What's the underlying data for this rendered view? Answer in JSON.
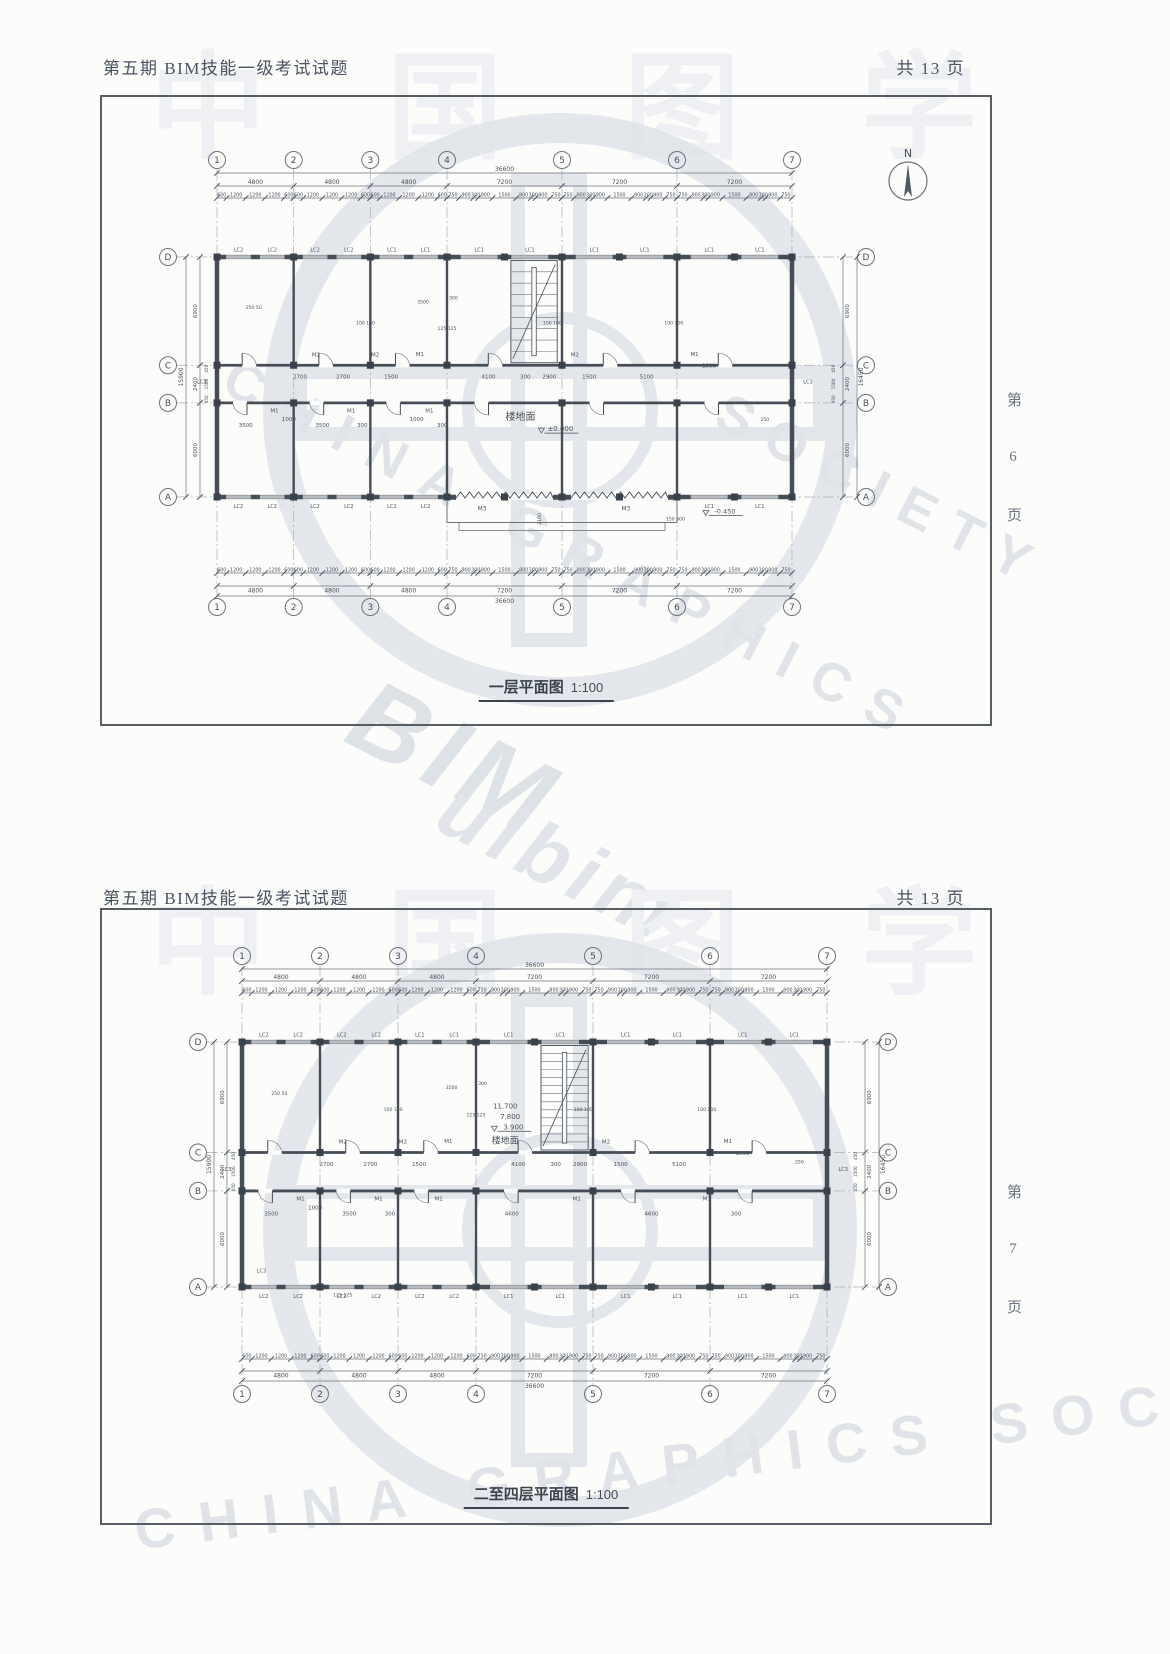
{
  "doc": {
    "header_title": "第五期 BIM技能一级考试试题",
    "pages_label": "共  13  页",
    "watermark": {
      "top_chars": "中 国 图 学",
      "diag_en1": "CHINA GRAPHICS",
      "diag_en2": "SOCIETY",
      "diag_en3": "CHINA GRAPHICS SOCIETY",
      "big1": "BIM",
      "big2": "uibim"
    }
  },
  "sections": [
    {
      "title": "一层平面图",
      "scale": "1:100",
      "side_page": "第 6 页",
      "north": "N",
      "axes_cols": [
        "1",
        "2",
        "3",
        "4",
        "5",
        "6",
        "7"
      ],
      "axes_rows": [
        "D",
        "C",
        "B",
        "A"
      ],
      "bays_mm": [
        4800,
        4800,
        4800,
        7200,
        7200,
        7200
      ],
      "rows_mm": [
        6900,
        2400,
        6000
      ],
      "dim_total_top": "36600",
      "dim_total_bottom": "36600",
      "detail_4800": [
        600,
        1200,
        1200,
        1200,
        600
      ],
      "detail_7200": [
        750,
        900,
        300,
        900,
        1500,
        900,
        300,
        900,
        750
      ],
      "side_left_total": "15900",
      "side_right_total": "16450",
      "side_sub": [
        450,
        1500,
        450
      ],
      "windows_top_bays": [
        [
          "LC2",
          "LC2"
        ],
        [
          "LC2",
          "LC2"
        ],
        [
          "LC1",
          "LC1"
        ],
        [
          "LC1",
          "LC1"
        ],
        [
          "LC1",
          "LC1"
        ],
        [
          "LC1",
          "LC1"
        ]
      ],
      "windows_bottom_bays": [
        [
          "LC2",
          "LC2"
        ],
        [
          "LC2",
          "LC2"
        ],
        [
          "LC2",
          "LC2"
        ],
        [],
        [],
        [
          "LC1",
          "LC1"
        ]
      ],
      "porch": true,
      "stair_treads": 8,
      "interior_labels": [
        {
          "t": "M2",
          "x": 6200,
          "y": 6350
        },
        {
          "t": "2700",
          "x": 5200,
          "y": 7750
        },
        {
          "t": "2700",
          "x": 7900,
          "y": 7750
        },
        {
          "t": "M2",
          "x": 9900,
          "y": 6350
        },
        {
          "t": "1500",
          "x": 10900,
          "y": 7750
        },
        {
          "t": "M1",
          "x": 12700,
          "y": 6300
        },
        {
          "t": "4100",
          "x": 17000,
          "y": 7750
        },
        {
          "t": "300",
          "x": 19300,
          "y": 7750
        },
        {
          "t": "2900",
          "x": 20800,
          "y": 7750
        },
        {
          "t": "M2",
          "x": 22400,
          "y": 6350
        },
        {
          "t": "1500",
          "x": 23300,
          "y": 7750
        },
        {
          "t": "5100",
          "x": 26900,
          "y": 7750
        },
        {
          "t": "M1",
          "x": 29900,
          "y": 6300
        },
        {
          "t": "1000",
          "x": 30800,
          "y": 7050
        },
        {
          "t": "M1",
          "x": 3600,
          "y": 9900
        },
        {
          "t": "1000",
          "x": 4500,
          "y": 10450
        },
        {
          "t": "3500",
          "x": 1800,
          "y": 10850
        },
        {
          "t": "M1",
          "x": 8400,
          "y": 9900
        },
        {
          "t": "3500",
          "x": 6600,
          "y": 10850
        },
        {
          "t": "300",
          "x": 9100,
          "y": 10850
        },
        {
          "t": "M1",
          "x": 13300,
          "y": 9900
        },
        {
          "t": "1000",
          "x": 12500,
          "y": 10450
        },
        {
          "t": "300",
          "x": 14100,
          "y": 10850
        },
        {
          "t": "楼地面",
          "x": 19000,
          "y": 10400,
          "s": 10
        },
        {
          "t": "±0.000",
          "x": 21500,
          "y": 11100,
          "s": 7,
          "lvl": true
        },
        {
          "t": "100 100",
          "x": 9300,
          "y": 4300,
          "s": 4.6
        },
        {
          "t": "125 125",
          "x": 14400,
          "y": 4650,
          "s": 4.6
        },
        {
          "t": "100 100",
          "x": 21000,
          "y": 4300,
          "s": 4.6
        },
        {
          "t": "100 100",
          "x": 28600,
          "y": 4300,
          "s": 4.6
        },
        {
          "t": "250 50",
          "x": 2300,
          "y": 3300,
          "s": 4.6
        },
        {
          "t": "3500",
          "x": 12900,
          "y": 2950,
          "s": 4.6
        },
        {
          "t": "300",
          "x": 14800,
          "y": 2700,
          "s": 4.6
        },
        {
          "t": "250",
          "x": 34300,
          "y": 10450,
          "s": 4.6
        },
        {
          "t": "LC3",
          "x": -950,
          "y": 8050,
          "s": 5
        },
        {
          "t": "LC3",
          "x": 37000,
          "y": 8050,
          "s": 5
        },
        {
          "t": "M3",
          "x": 16600,
          "y": 16150,
          "s": 6
        },
        {
          "t": "M3",
          "x": 25600,
          "y": 16150,
          "s": 6
        },
        {
          "t": "2100",
          "x": 20300,
          "y": 16700,
          "s": 4.6,
          "rot": -90
        },
        {
          "t": "-0.450",
          "x": 31800,
          "y": 16350,
          "s": 6.5,
          "lvl": true
        },
        {
          "t": "150 300",
          "x": 28700,
          "y": 16800,
          "s": 4.6
        }
      ]
    },
    {
      "title": "二至四层平面图",
      "scale": "1:100",
      "side_page": "第 7 页",
      "north": null,
      "axes_cols": [
        "1",
        "2",
        "3",
        "4",
        "5",
        "6",
        "7"
      ],
      "axes_rows": [
        "D",
        "C",
        "B",
        "A"
      ],
      "bays_mm": [
        4800,
        4800,
        4800,
        7200,
        7200,
        7200
      ],
      "rows_mm": [
        6900,
        2400,
        6000
      ],
      "dim_total_top": "36600",
      "dim_total_bottom": "36600",
      "detail_4800": [
        600,
        1200,
        1200,
        1200,
        600
      ],
      "detail_7200": [
        750,
        900,
        300,
        900,
        1500,
        900,
        300,
        900,
        750
      ],
      "side_left_total": "15900",
      "side_right_total": "16450",
      "side_sub": [
        450,
        1500,
        450
      ],
      "windows_top_bays": [
        [
          "LC2",
          "LC2"
        ],
        [
          "LC2",
          "LC2"
        ],
        [
          "LC1",
          "LC1"
        ],
        [
          "LC1",
          "LC1"
        ],
        [
          "LC1",
          "LC1"
        ],
        [
          "LC1",
          "LC1"
        ]
      ],
      "windows_bottom_bays": [
        [
          "LC2",
          "LC2"
        ],
        [
          "LC2",
          "LC2"
        ],
        [
          "LC2",
          "LC2"
        ],
        [
          "LC1",
          "LC1"
        ],
        [
          "LC1",
          "LC1"
        ],
        [
          "LC1",
          "LC1"
        ]
      ],
      "porch": false,
      "stair_treads": 12,
      "interior_labels": [
        {
          "t": "M2",
          "x": 6200,
          "y": 6350
        },
        {
          "t": "2700",
          "x": 5200,
          "y": 7750
        },
        {
          "t": "2700",
          "x": 7900,
          "y": 7750
        },
        {
          "t": "M2",
          "x": 9900,
          "y": 6350
        },
        {
          "t": "1500",
          "x": 10900,
          "y": 7750
        },
        {
          "t": "M1",
          "x": 12700,
          "y": 6300
        },
        {
          "t": "4100",
          "x": 17000,
          "y": 7750
        },
        {
          "t": "300",
          "x": 19300,
          "y": 7750
        },
        {
          "t": "2900",
          "x": 20800,
          "y": 7750
        },
        {
          "t": "M2",
          "x": 22400,
          "y": 6350
        },
        {
          "t": "1500",
          "x": 23300,
          "y": 7750
        },
        {
          "t": "5100",
          "x": 26900,
          "y": 7750
        },
        {
          "t": "M1",
          "x": 29900,
          "y": 6300
        },
        {
          "t": "1000",
          "x": 30800,
          "y": 7050
        },
        {
          "t": "M1",
          "x": 3600,
          "y": 9900
        },
        {
          "t": "1000",
          "x": 4500,
          "y": 10450
        },
        {
          "t": "3500",
          "x": 1800,
          "y": 10850
        },
        {
          "t": "M1",
          "x": 8400,
          "y": 9900
        },
        {
          "t": "3500",
          "x": 6600,
          "y": 10850
        },
        {
          "t": "300",
          "x": 9100,
          "y": 10850
        },
        {
          "t": "M1",
          "x": 12100,
          "y": 9900
        },
        {
          "t": "4600",
          "x": 16600,
          "y": 10850
        },
        {
          "t": "M1",
          "x": 20600,
          "y": 9900
        },
        {
          "t": "4600",
          "x": 25200,
          "y": 10850
        },
        {
          "t": "M1",
          "x": 28600,
          "y": 9900
        },
        {
          "t": "300",
          "x": 30400,
          "y": 10850
        },
        {
          "t": "11.700",
          "x": 16200,
          "y": 4150,
          "s": 7
        },
        {
          "t": "7.800",
          "x": 16500,
          "y": 4800,
          "s": 7
        },
        {
          "t": "3.900",
          "x": 16700,
          "y": 5450,
          "s": 7,
          "lvl": true
        },
        {
          "t": "楼地面",
          "x": 16200,
          "y": 6350,
          "s": 9
        },
        {
          "t": "100 100",
          "x": 9300,
          "y": 4300,
          "s": 4.6
        },
        {
          "t": "125 125",
          "x": 14400,
          "y": 4650,
          "s": 4.6
        },
        {
          "t": "100 100",
          "x": 21000,
          "y": 4300,
          "s": 4.6
        },
        {
          "t": "100 100",
          "x": 28600,
          "y": 4300,
          "s": 4.6
        },
        {
          "t": "250 50",
          "x": 2300,
          "y": 3300,
          "s": 4.6
        },
        {
          "t": "3500",
          "x": 12900,
          "y": 2950,
          "s": 4.6
        },
        {
          "t": "300",
          "x": 14800,
          "y": 2700,
          "s": 4.6
        },
        {
          "t": "250",
          "x": 34300,
          "y": 7600,
          "s": 4.6
        },
        {
          "t": "LC3",
          "x": -950,
          "y": 8050,
          "s": 5
        },
        {
          "t": "LC3",
          "x": 37000,
          "y": 8050,
          "s": 5
        },
        {
          "t": "LC3",
          "x": 1200,
          "y": 14400,
          "s": 5
        },
        {
          "t": "125 125",
          "x": 6200,
          "y": 15900,
          "s": 4.6
        }
      ]
    }
  ]
}
